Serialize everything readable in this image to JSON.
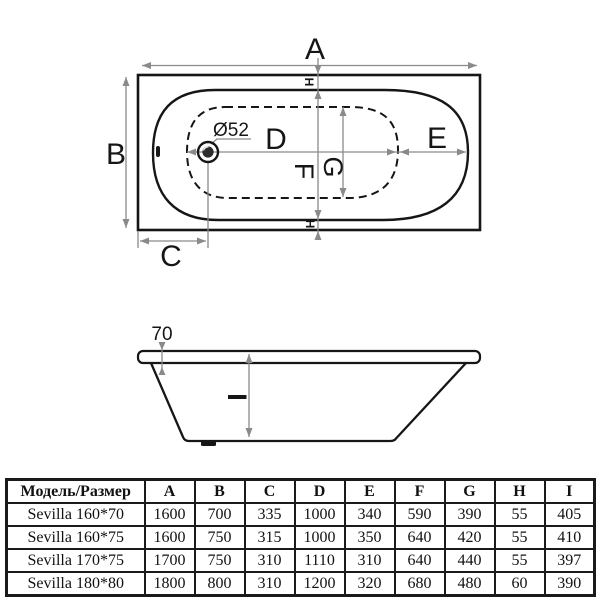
{
  "top_view": {
    "labels": {
      "A": "A",
      "B": "B",
      "C": "C",
      "D": "D",
      "E": "E",
      "F": "F",
      "G": "G",
      "H_top": "H",
      "H_bottom": "H"
    },
    "drain_label": "Ø52"
  },
  "side_view": {
    "rim_height_label": "70",
    "depth_label": "I"
  },
  "table": {
    "headers": [
      "Модель/Размер",
      "A",
      "B",
      "C",
      "D",
      "E",
      "F",
      "G",
      "H",
      "I"
    ],
    "rows": [
      {
        "model": "Sevilla 160*70",
        "values": [
          "1600",
          "700",
          "335",
          "1000",
          "340",
          "590",
          "390",
          "55",
          "405"
        ]
      },
      {
        "model": "Sevilla 160*75",
        "values": [
          "1600",
          "750",
          "315",
          "1000",
          "350",
          "640",
          "420",
          "55",
          "410"
        ]
      },
      {
        "model": "Sevilla 170*75",
        "values": [
          "1700",
          "750",
          "310",
          "1110",
          "310",
          "640",
          "440",
          "55",
          "397"
        ]
      },
      {
        "model": "Sevilla 180*80",
        "values": [
          "1800",
          "800",
          "310",
          "1200",
          "320",
          "680",
          "480",
          "60",
          "390"
        ]
      }
    ]
  },
  "colors": {
    "line": "#161616",
    "dimension": "#8a8a8a",
    "tub_fill_top": "#f7f7f7",
    "tub_fill_bottom": "#e8e8e8",
    "bottom_zone_fill": "#dbdbdb"
  }
}
